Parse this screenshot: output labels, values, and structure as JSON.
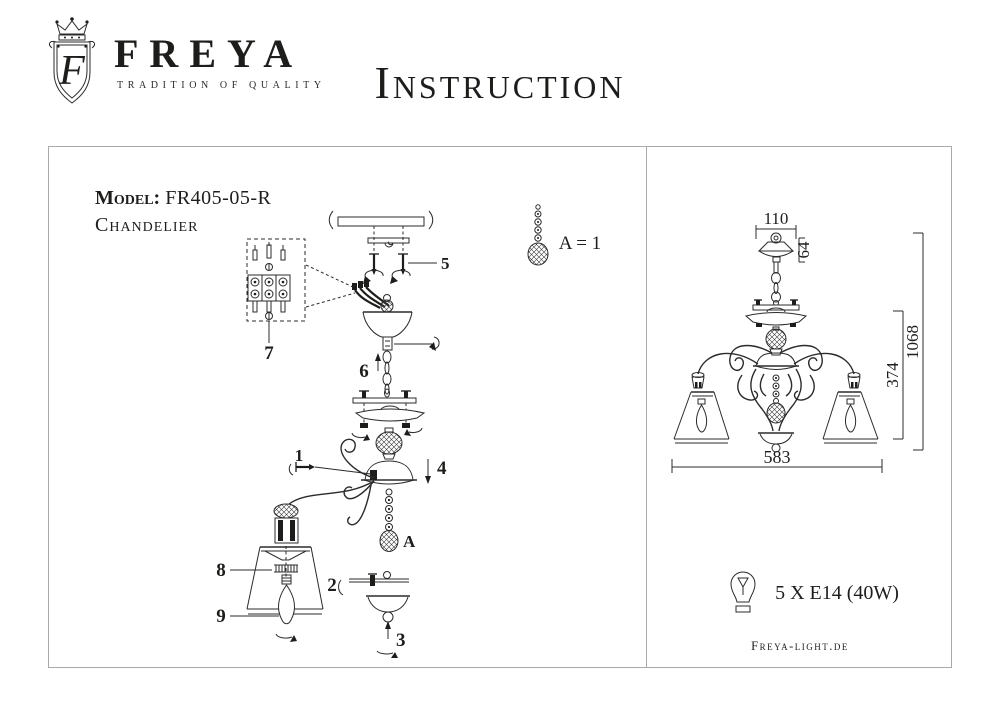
{
  "header": {
    "brand": "FREYA",
    "tagline": "TRADITION OF QUALITY",
    "monogram": "F",
    "title": "Instruction"
  },
  "panel": {
    "model_label": "Model:",
    "model_value": "FR405-05-R",
    "product_type": "Chandelier",
    "legend_text": "A = 1"
  },
  "callouts": {
    "c1": "1",
    "c2": "2",
    "c3": "3",
    "c4": "4",
    "c5": "5",
    "c6": "6",
    "c7": "7",
    "c8": "8",
    "c9": "9",
    "ca": "A"
  },
  "dimensions": {
    "canopy_width": "110",
    "canopy_height": "64",
    "body_height": "374",
    "total_height": "1068",
    "total_width": "583"
  },
  "spec": {
    "bulbs": "5 X E14 (40W)",
    "website": "Freya-light.de"
  },
  "colors": {
    "ink": "#1d1d1b",
    "frame_border": "#a9a9a9",
    "paper": "#ffffff"
  }
}
